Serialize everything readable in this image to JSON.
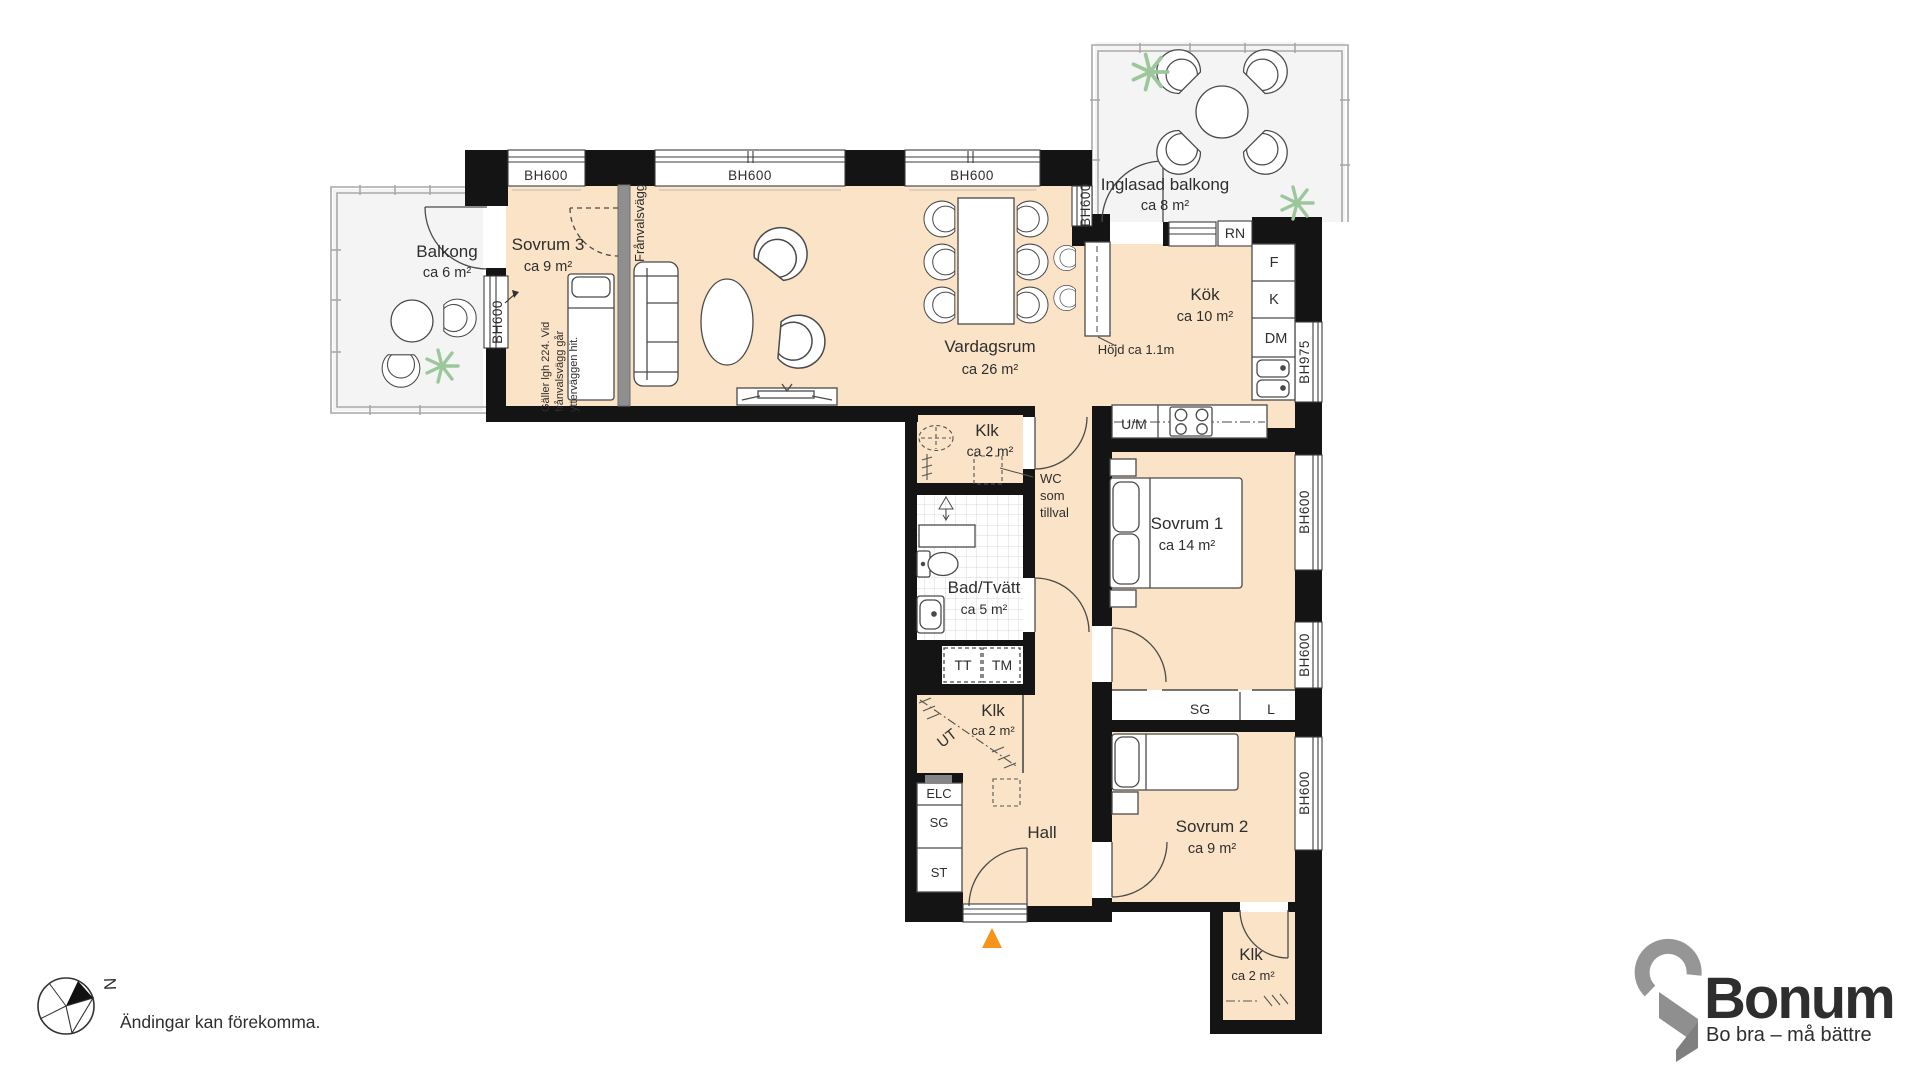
{
  "rooms": {
    "balkong": {
      "name": "Balkong",
      "area": "ca 6 m²"
    },
    "sovrum3": {
      "name": "Sovrum 3",
      "area": "ca 9 m²"
    },
    "vardagsrum": {
      "name": "Vardagsrum",
      "area": "ca 26 m²"
    },
    "inglasad": {
      "name": "Inglasad balkong",
      "area": "ca 8 m²"
    },
    "kok": {
      "name": "Kök",
      "area": "ca 10 m²"
    },
    "klk1": {
      "name": "Klk",
      "area": "ca 2 m²"
    },
    "bad": {
      "name": "Bad/Tvätt",
      "area": "ca 5 m²"
    },
    "sovrum1": {
      "name": "Sovrum 1",
      "area": "ca 14 m²"
    },
    "klk2": {
      "name": "Klk",
      "area": "ca 2 m²"
    },
    "hall": {
      "name": "Hall"
    },
    "sovrum2": {
      "name": "Sovrum 2",
      "area": "ca 9 m²"
    },
    "klk3": {
      "name": "Klk",
      "area": "ca 2 m²"
    }
  },
  "windows": {
    "bh600": "BH600",
    "bh975": "BH975"
  },
  "fixtures": {
    "f": "F",
    "k": "K",
    "dm": "DM",
    "um": "U/M",
    "rn": "RN",
    "tt": "TT",
    "tm": "TM",
    "elc": "ELC",
    "sg": "SG",
    "st": "ST",
    "sg_wardrobe": "SG",
    "l": "L",
    "ut": "UT"
  },
  "annotations": {
    "franvalsvagg": "Frånvalsvägg",
    "note_line1": "Gäller lgh 224. Vid",
    "note_line2": "frånvalsvägg går",
    "note_line3": "ytterväggen hit.",
    "wc_line1": "WC",
    "wc_line2": "som",
    "wc_line3": "tillval",
    "hojd": "Höjd ca 1.1m"
  },
  "footer": {
    "disclaimer": "Ändingar kan förekomma.",
    "north": "N"
  },
  "logo": {
    "brand": "Bonum",
    "tagline": "Bo bra – må bättre"
  },
  "colors": {
    "floor": "#FAE3C6",
    "wall": "#141414",
    "outdoor": "#F4F4F4",
    "accent": "#F7941E"
  }
}
